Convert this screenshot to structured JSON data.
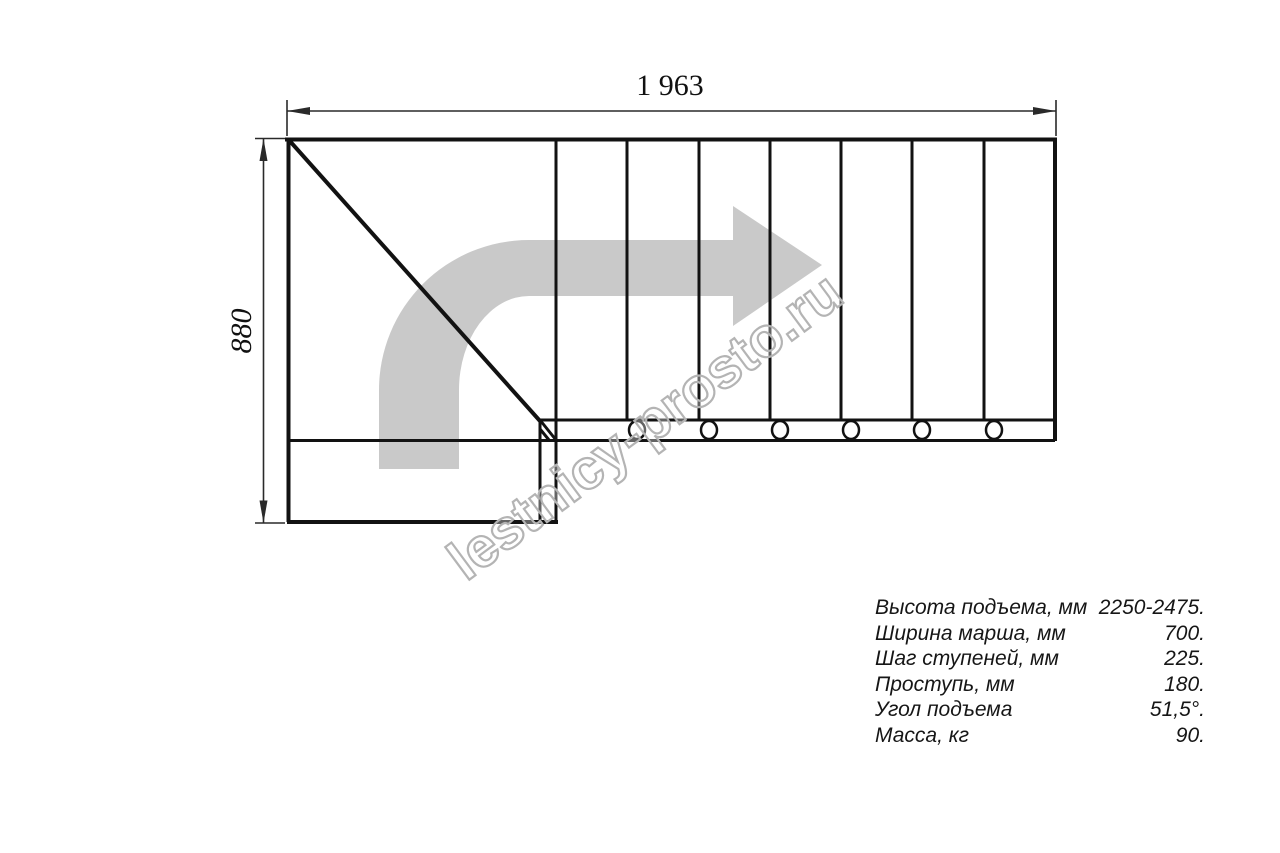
{
  "page": {
    "background": "#ffffff"
  },
  "drawing": {
    "title": "staircase-plan-top-view",
    "dimension_width": "1 963",
    "dimension_height": "880",
    "step_lines_count": 7,
    "fastener_circles_count": 6
  },
  "watermark": {
    "text": "lestnicy-prosto.ru"
  },
  "specs": {
    "rows": [
      {
        "label": "Высота подъема, мм",
        "value": "2250-2475."
      },
      {
        "label": "Ширина марша, мм",
        "value": "700."
      },
      {
        "label": "Шаг ступеней, мм",
        "value": "225."
      },
      {
        "label": "Проступь, мм",
        "value": "180."
      },
      {
        "label": "Угол подъема",
        "value": "51,5°."
      },
      {
        "label": "Масса, кг",
        "value": "90."
      }
    ]
  },
  "colors": {
    "line": "#121212",
    "dimension_line": "#2a2a2a",
    "arrow_fill": "#c9c9c9",
    "watermark_outline": "#b4b4b4"
  }
}
